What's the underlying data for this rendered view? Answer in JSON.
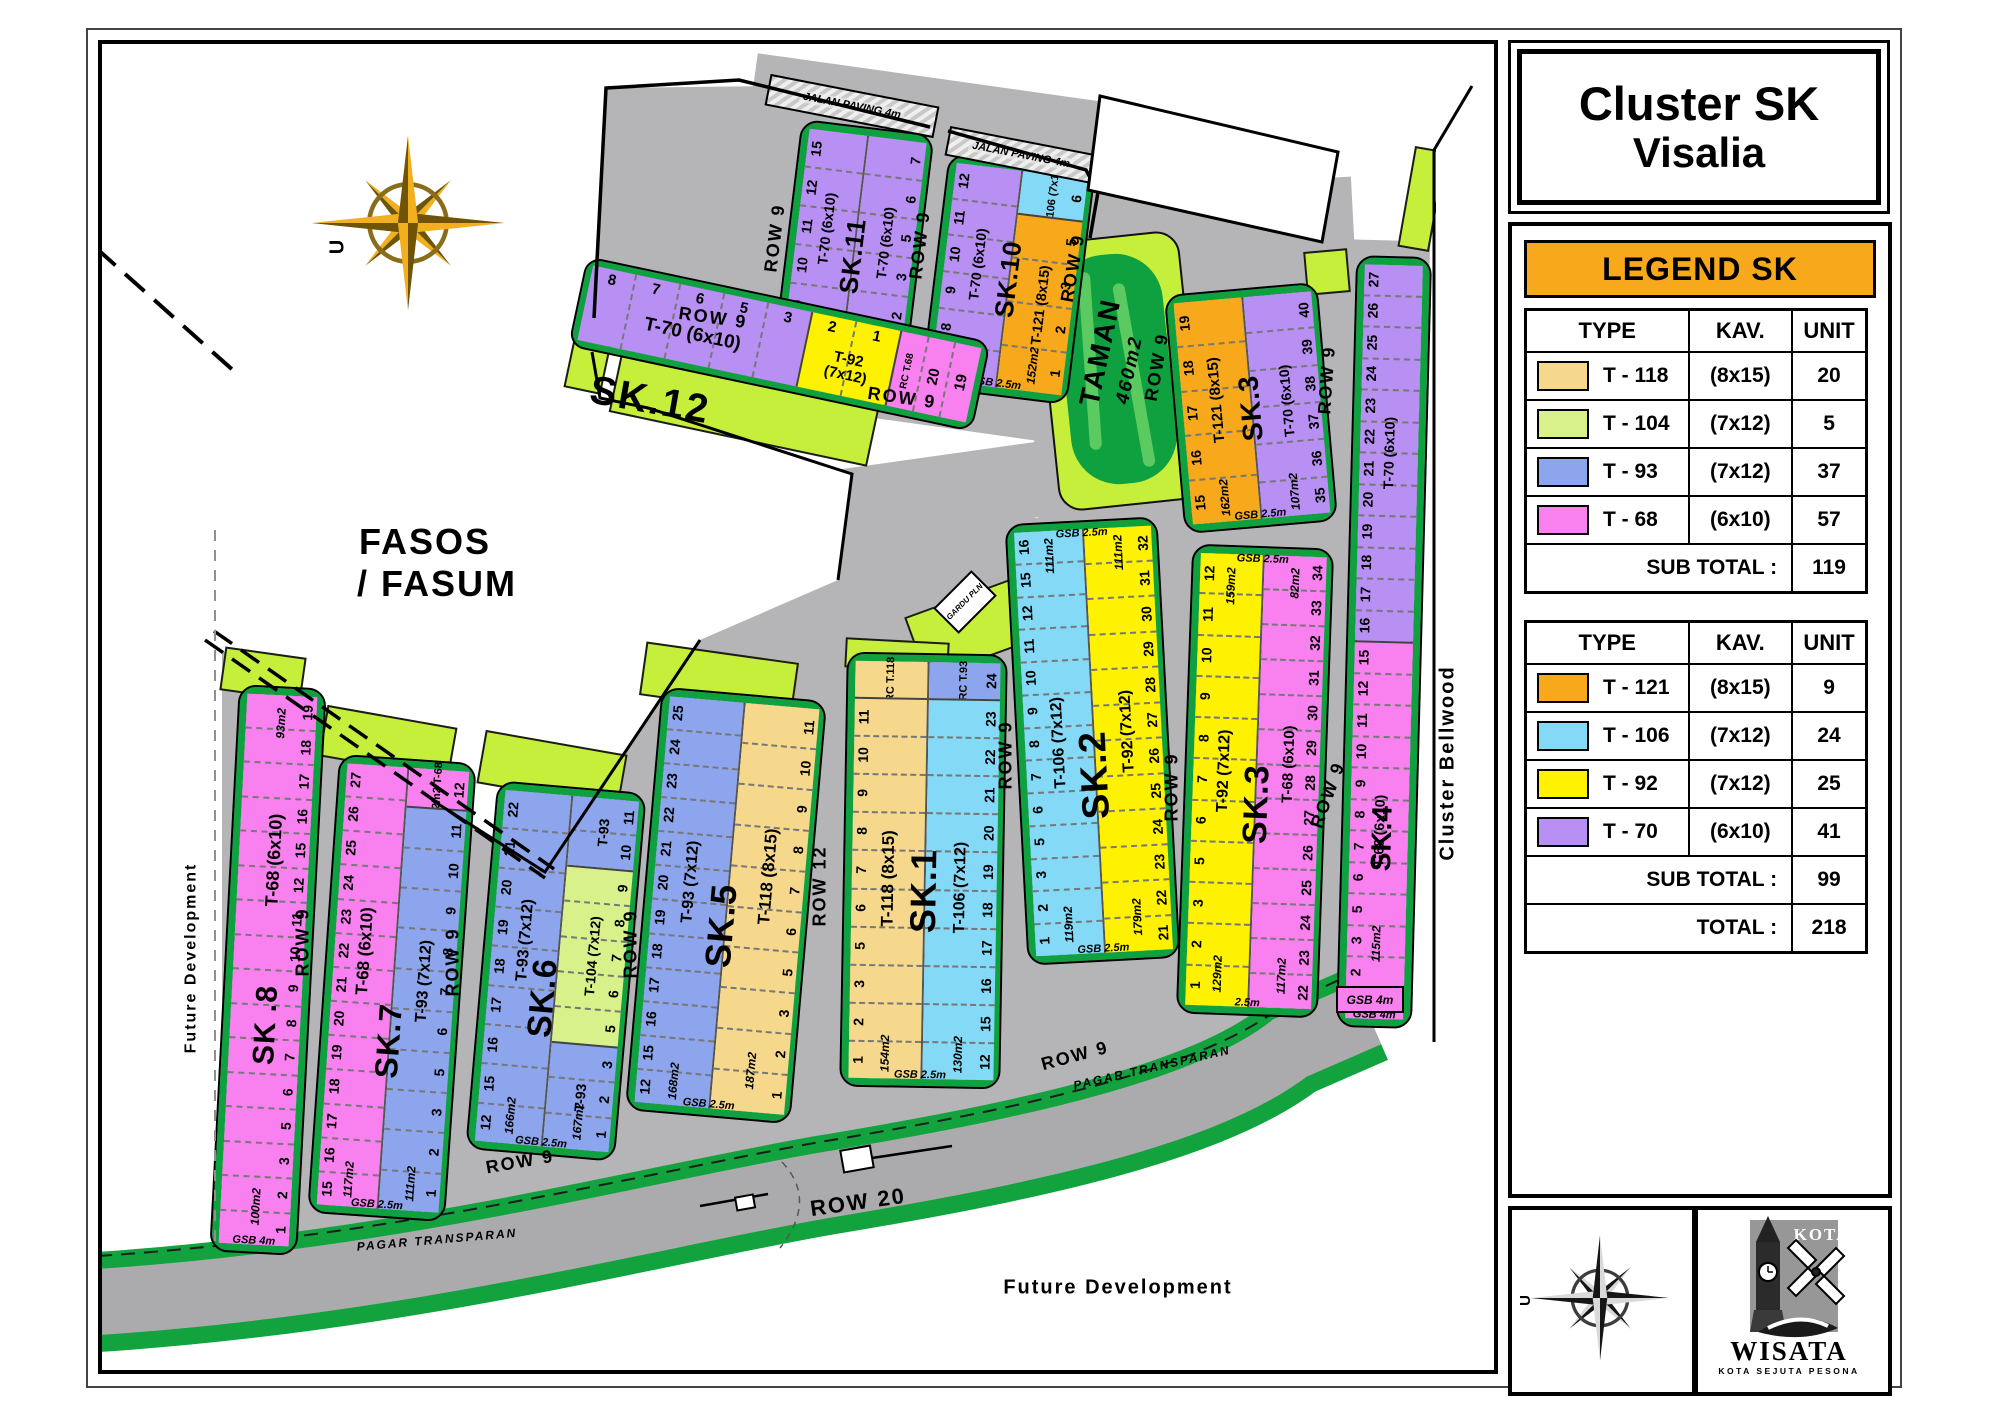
{
  "title": {
    "line1": "Cluster SK",
    "line2": "Visalia"
  },
  "legend": {
    "header": "LEGEND SK",
    "col_headers": [
      "TYPE",
      "KAV.",
      "UNIT"
    ],
    "tables": [
      {
        "rows": [
          {
            "type": "T - 118",
            "color": "#F6D88C",
            "kav": "(8x15)",
            "unit": "20"
          },
          {
            "type": "T - 104",
            "color": "#D8F18B",
            "kav": "(7x12)",
            "unit": "5"
          },
          {
            "type": "T - 93",
            "color": "#8CA5EC",
            "kav": "(7x12)",
            "unit": "37"
          },
          {
            "type": "T - 68",
            "color": "#F980EF",
            "kav": "(6x10)",
            "unit": "57"
          }
        ],
        "subtotal_label": "SUB TOTAL  :",
        "subtotal": "119"
      },
      {
        "rows": [
          {
            "type": "T - 121",
            "color": "#F7A81B",
            "kav": "(8x15)",
            "unit": "9"
          },
          {
            "type": "T - 106",
            "color": "#83D9F6",
            "kav": "(7x12)",
            "unit": "24"
          },
          {
            "type": "T - 92",
            "color": "#FEF200",
            "kav": "(7x12)",
            "unit": "25"
          },
          {
            "type": "T - 70",
            "color": "#B88FF2",
            "kav": "(6x10)",
            "unit": "41"
          }
        ],
        "subtotal_label": "SUB TOTAL  :",
        "subtotal": "99",
        "total_label": "TOTAL  :",
        "total": "218"
      }
    ]
  },
  "panel": {
    "compass_letter": "U"
  },
  "logo": {
    "kota": "KOTA",
    "name": "WISATA",
    "tagline": "KOTA SEJUTA PESONA"
  },
  "map": {
    "texts": {
      "row9": "ROW 9",
      "row12": "ROW 12",
      "row20": "ROW 20",
      "pagar": "PAGAR TRANSPARAN",
      "jalan": "JALAN PAVING 4m",
      "fasos1": "FASOS",
      "fasos2": "/ FASUM",
      "future": "Future Development",
      "bellwood": "Cluster Bellwood",
      "taman1": "TAMAN",
      "taman2": "460m2",
      "gardu": "GARDU PLN",
      "gsb4m": "GSB 4m",
      "sk12name": "SK.12",
      "compass": "U"
    },
    "blocks": [
      {
        "id": "sk11",
        "name": "SK.11",
        "gsb": "GSB 2.5m",
        "cols": [
          {
            "type": "T-70 (6x10)",
            "area_bottom": "118m2",
            "segs": [
              {
                "c": "t70",
                "nums": [
                  "15",
                  "12",
                  "11",
                  "10",
                  "9",
                  "8"
                ]
              }
            ]
          },
          {
            "type": "T-70 (6x10)",
            "area_bottom": "112m2",
            "segs": [
              {
                "c": "t70",
                "nums": [
                  "7",
                  "6",
                  "5",
                  "3",
                  "2",
                  "1"
                ]
              }
            ]
          }
        ]
      },
      {
        "id": "sk10",
        "name": "SK.10",
        "gsb": "GSB 2.5m",
        "cols": [
          {
            "type": "T-70 (6x10)",
            "area_bottom": "118m2",
            "segs": [
              {
                "c": "t70",
                "nums": [
                  "12",
                  "11",
                  "10",
                  "9",
                  "8",
                  "7"
                ]
              }
            ]
          },
          {
            "area_bottom": "152m2",
            "segs": [
              {
                "c": "t106",
                "label": "T-106 (7x15)",
                "nums": [
                  "6"
                ]
              },
              {
                "c": "t121",
                "type": "T-121 (8x15)",
                "nums": [
                  "5",
                  "3",
                  "2",
                  "1"
                ]
              }
            ]
          }
        ]
      },
      {
        "id": "sk3t",
        "name": "SK.3",
        "gsb": "GSB 2.5m",
        "cols": [
          {
            "type": "T-121 (8x15)",
            "area_bottom": "162m2",
            "segs": [
              {
                "c": "t121",
                "nums": [
                  "19",
                  "18",
                  "17",
                  "16",
                  "15"
                ]
              }
            ]
          },
          {
            "type": "T-70 (6x10)",
            "area_bottom": "107m2",
            "segs": [
              {
                "c": "t70",
                "nums": [
                  "40",
                  "39",
                  "38",
                  "37",
                  "36",
                  "35"
                ]
              }
            ]
          }
        ]
      },
      {
        "id": "sk4",
        "name": "SK.4",
        "gsb": "GSB 4m",
        "cols": [
          {
            "area_bottom": "115m2",
            "segs": [
              {
                "c": "t70",
                "type": "T-70 (6x10)",
                "nums": [
                  "27",
                  "26",
                  "25",
                  "24",
                  "23",
                  "22",
                  "21",
                  "20",
                  "19",
                  "18",
                  "17",
                  "16"
                ]
              },
              {
                "c": "t68",
                "type": "T-68 (6x10)",
                "nums": [
                  "15",
                  "12",
                  "11",
                  "10",
                  "9",
                  "8",
                  "7",
                  "6",
                  "5",
                  "3",
                  "2",
                  "1"
                ]
              }
            ]
          }
        ]
      },
      {
        "id": "sk8",
        "name": "SK .8",
        "gsb": "GSB 4m",
        "cols": [
          {
            "type": "T-68  (6x10)",
            "area_top": "93m2",
            "area_bottom": "100m2",
            "segs": [
              {
                "c": "t68",
                "nums": [
                  "19",
                  "18",
                  "17",
                  "16",
                  "15",
                  "12",
                  "11",
                  "10",
                  "9",
                  "8",
                  "7",
                  "6",
                  "5",
                  "3",
                  "2",
                  "1"
                ]
              }
            ]
          }
        ]
      },
      {
        "id": "sk7",
        "name": "SK.7",
        "gsb": "GSB 2.5m",
        "cols": [
          {
            "type": "T-68  (6x10)",
            "area_bottom": "117m2",
            "segs": [
              {
                "c": "t68",
                "nums": [
                  "27",
                  "26",
                  "25",
                  "24",
                  "23",
                  "22",
                  "21",
                  "20",
                  "19",
                  "18",
                  "17",
                  "16",
                  "15"
                ]
              }
            ]
          },
          {
            "type": "T-93 (7x12)",
            "area_bottom": "111m2",
            "segs": [
              {
                "c": "t68",
                "label": "72m2 T-68",
                "nums": [
                  "12"
                ]
              },
              {
                "c": "t93",
                "nums": [
                  "11",
                  "10",
                  "9",
                  "8",
                  "7",
                  "6",
                  "5",
                  "3",
                  "2",
                  "1"
                ]
              }
            ]
          }
        ]
      },
      {
        "id": "sk6",
        "name": "SK.6",
        "gsb": "GSB 2.5m",
        "cols": [
          {
            "type": "T-93 (7x12)",
            "area_bottom": "166m2",
            "segs": [
              {
                "c": "t93",
                "nums": [
                  "22",
                  "21",
                  "20",
                  "19",
                  "18",
                  "17",
                  "16",
                  "15",
                  "12"
                ]
              }
            ]
          },
          {
            "area_bottom": "167m2",
            "segs": [
              {
                "c": "t93",
                "type": "T-93",
                "nums": [
                  "11",
                  "10"
                ]
              },
              {
                "c": "t104",
                "type": "T-104 (7x12)",
                "nums": [
                  "9",
                  "8",
                  "7",
                  "6",
                  "5"
                ]
              },
              {
                "c": "t93",
                "type": "T-93",
                "nums": [
                  "3",
                  "2",
                  "1"
                ]
              }
            ]
          }
        ]
      },
      {
        "id": "sk5",
        "name": "SK.5",
        "gsb": "GSB 2.5m",
        "cols": [
          {
            "type": "T-93 (7x12)",
            "area_bottom": "168m2",
            "segs": [
              {
                "c": "t93",
                "nums": [
                  "25",
                  "24",
                  "23",
                  "22",
                  "21",
                  "20",
                  "19",
                  "18",
                  "17",
                  "16",
                  "15",
                  "12"
                ]
              }
            ]
          },
          {
            "type": "T-118 (8x15)",
            "area_bottom": "187m2",
            "segs": [
              {
                "c": "t118",
                "nums": [
                  "11",
                  "10",
                  "9",
                  "8",
                  "7",
                  "6",
                  "5",
                  "3",
                  "2",
                  "1"
                ]
              }
            ]
          }
        ]
      },
      {
        "id": "sk1",
        "name": "SK.1",
        "gsb": "GSB 2.5m",
        "cols": [
          {
            "type": "T-118 (8x15)",
            "area_bottom": "154m2",
            "segs": [
              {
                "c": "t118",
                "label": "RC T.118",
                "nums": []
              },
              {
                "c": "t118",
                "nums": [
                  "11",
                  "10",
                  "9",
                  "8",
                  "7",
                  "6",
                  "5",
                  "3",
                  "2",
                  "1"
                ]
              }
            ]
          },
          {
            "type": "T-106 (7x12)",
            "area_bottom": "130m2",
            "segs": [
              {
                "c": "t93",
                "label": "RC T.93",
                "nums": [
                  "24"
                ]
              },
              {
                "c": "t106",
                "nums": [
                  "23",
                  "22",
                  "21",
                  "20",
                  "19",
                  "18",
                  "17",
                  "16",
                  "15",
                  "12"
                ]
              }
            ]
          }
        ]
      },
      {
        "id": "sk2",
        "name": "SK.2",
        "gsb_top": "GSB 2.5m",
        "gsb": "GSB 2.5m",
        "cols": [
          {
            "type": "T-106 (7x12)",
            "area_top": "111m2",
            "area_bottom": "119m2",
            "segs": [
              {
                "c": "t106",
                "nums": [
                  "16",
                  "15",
                  "12",
                  "11",
                  "10",
                  "9",
                  "8",
                  "7",
                  "6",
                  "5",
                  "3",
                  "2",
                  "1"
                ]
              }
            ]
          },
          {
            "type": "T-92 (7x12)",
            "area_top": "111m2",
            "area_bottom": "179m2",
            "segs": [
              {
                "c": "t92",
                "nums": [
                  "32",
                  "31",
                  "30",
                  "29",
                  "28",
                  "27",
                  "26",
                  "25",
                  "24",
                  "23",
                  "22",
                  "21"
                ]
              }
            ]
          }
        ]
      },
      {
        "id": "sk3b",
        "name": "SK.3",
        "gsb_top": "GSB 2.5m",
        "gsb": "2.5m",
        "cols": [
          {
            "type": "T-92 (7x12)",
            "area_top": "159m2",
            "area_bottom": "129m2",
            "segs": [
              {
                "c": "t92",
                "nums": [
                  "12",
                  "11",
                  "10",
                  "9",
                  "8",
                  "7",
                  "6",
                  "5",
                  "3",
                  "2",
                  "1"
                ]
              }
            ]
          },
          {
            "type": "T-68  (6x10)",
            "area_top": "82m2",
            "area_bottom": "117m2",
            "segs": [
              {
                "c": "t68",
                "nums": [
                  "34",
                  "33",
                  "32",
                  "31",
                  "30",
                  "29",
                  "28",
                  "27",
                  "26",
                  "25",
                  "24",
                  "23",
                  "22"
                ]
              }
            ]
          }
        ]
      }
    ],
    "sk12": {
      "name": "SK.12",
      "segs": [
        {
          "c": "t70",
          "type": "T-70 (6x10)",
          "nums": [
            "8",
            "7",
            "6",
            "5",
            "3"
          ]
        },
        {
          "c": "t92",
          "type": "T-92\n(7x12)",
          "nums": [
            "2",
            "1"
          ]
        },
        {
          "c": "t68",
          "label": "RC T.68",
          "nums": [
            "20",
            "19"
          ],
          "vertical": true
        }
      ]
    }
  }
}
